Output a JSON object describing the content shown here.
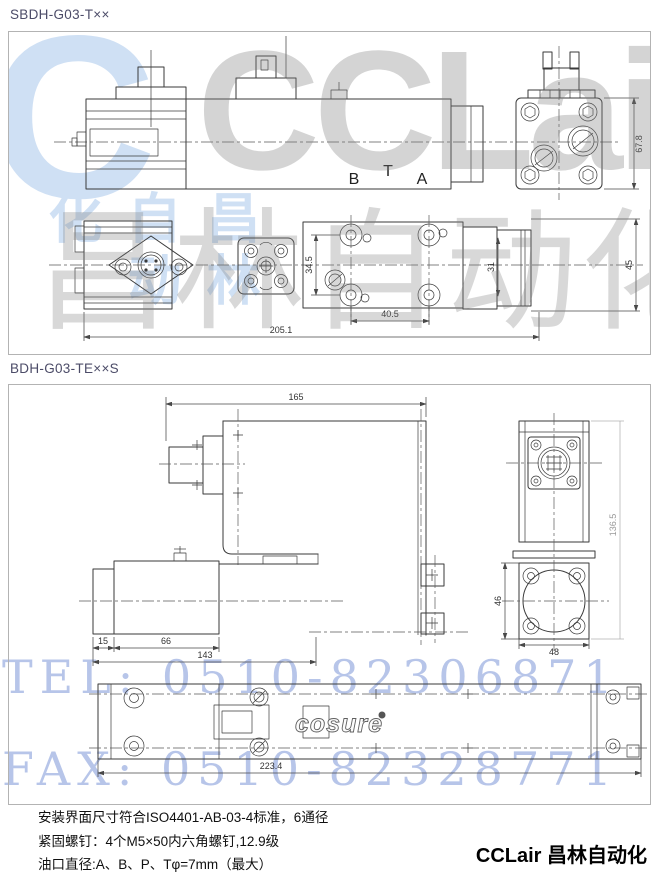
{
  "section1": {
    "title": "SBDH-G03-T××",
    "ports": {
      "b": "B",
      "t": "T",
      "a": "A"
    },
    "dims": {
      "end_height": "67.8",
      "total_length": "205.1",
      "bolt_h": "40.5",
      "bolt_v": "34.5",
      "cap_inner": "31",
      "cap_outer": "45"
    }
  },
  "section2": {
    "title": "BDH-G03-TE××S",
    "logo": "cosure",
    "dims": {
      "top_length": "165",
      "overall_height": "136.5",
      "block_height": "46",
      "block_width": "48",
      "cap": "15",
      "coil": "66",
      "sol_length": "143",
      "total_length": "223.4"
    }
  },
  "watermark": {
    "logo_letter": "C",
    "brand_latin": "CCLair",
    "brand_cjk": "昌林自动化",
    "tel": "TEL: 0510-82306871",
    "fax": "FAX: 0510-82328771",
    "colors": {
      "blue": "#cfe0f4",
      "gray": "#7d7d7d",
      "contact_blue": "#b7c5e9"
    }
  },
  "notes": [
    "安装界面尺寸符合ISO4401-AB-03-4标准，6通径",
    "紧固螺钉：4个M5×50内六角螺钉,12.9级",
    "油口直径:A、B、P、Tφ=7mm（最大）"
  ],
  "footer": {
    "brand": "CCLair 昌林自动化"
  }
}
